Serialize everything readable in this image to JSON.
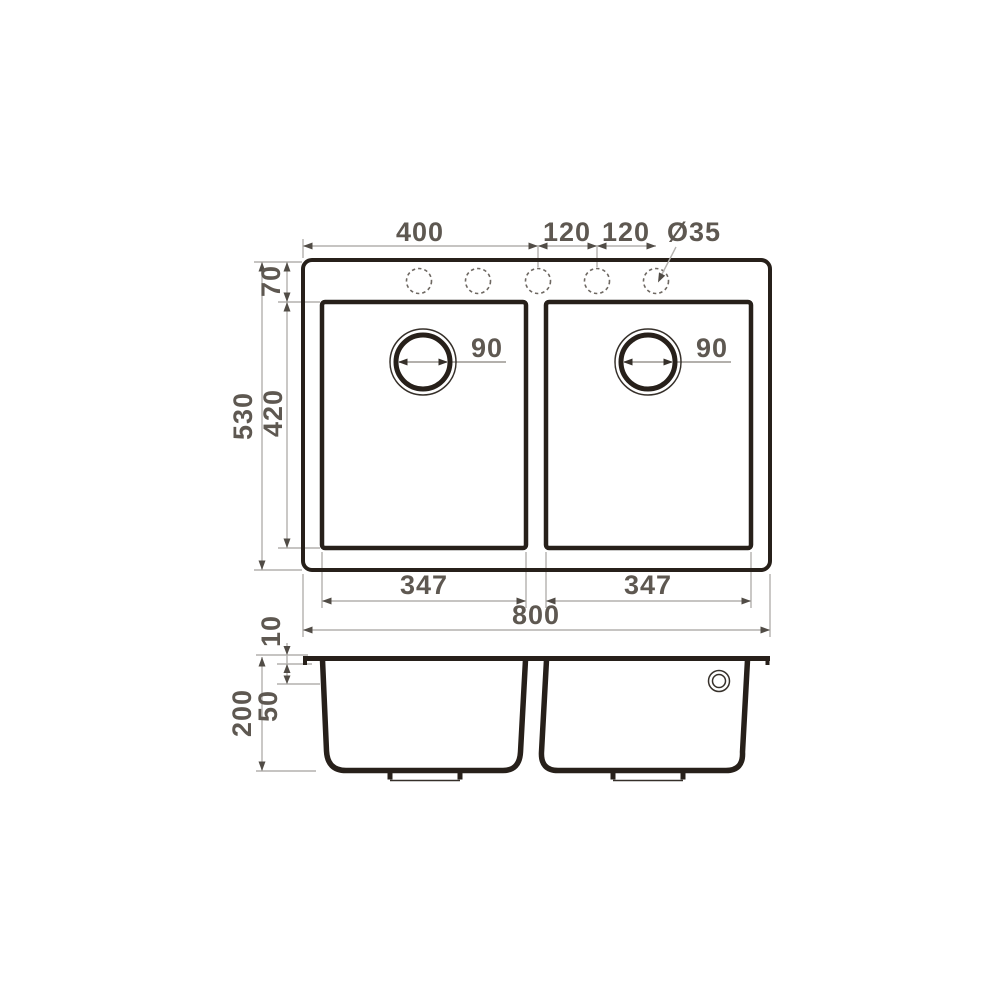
{
  "drawing": {
    "type": "sink-dimension-drawing",
    "colors": {
      "outline": "#27201a",
      "dimension_line": "#b3b1ae",
      "dimension_text": "#5e5851",
      "arrow": "#514c46",
      "background": "#ffffff"
    },
    "top_view": {
      "hole_offset_label": "400",
      "hole_pitch_label_1": "120",
      "hole_pitch_label_2": "120",
      "faucet_hole_diameter_label": "Ø35",
      "rim_depth_label": "70",
      "overall_depth_label": "530",
      "bowl_depth_label": "420",
      "left_drain_diameter_label": "90",
      "right_drain_diameter_label": "90",
      "left_bowl_width_label": "347",
      "right_bowl_width_label": "347",
      "overall_width_label": "800"
    },
    "side_view": {
      "rim_thickness_label": "10",
      "overflow_offset_label": "50",
      "overall_height_label": "200"
    }
  }
}
